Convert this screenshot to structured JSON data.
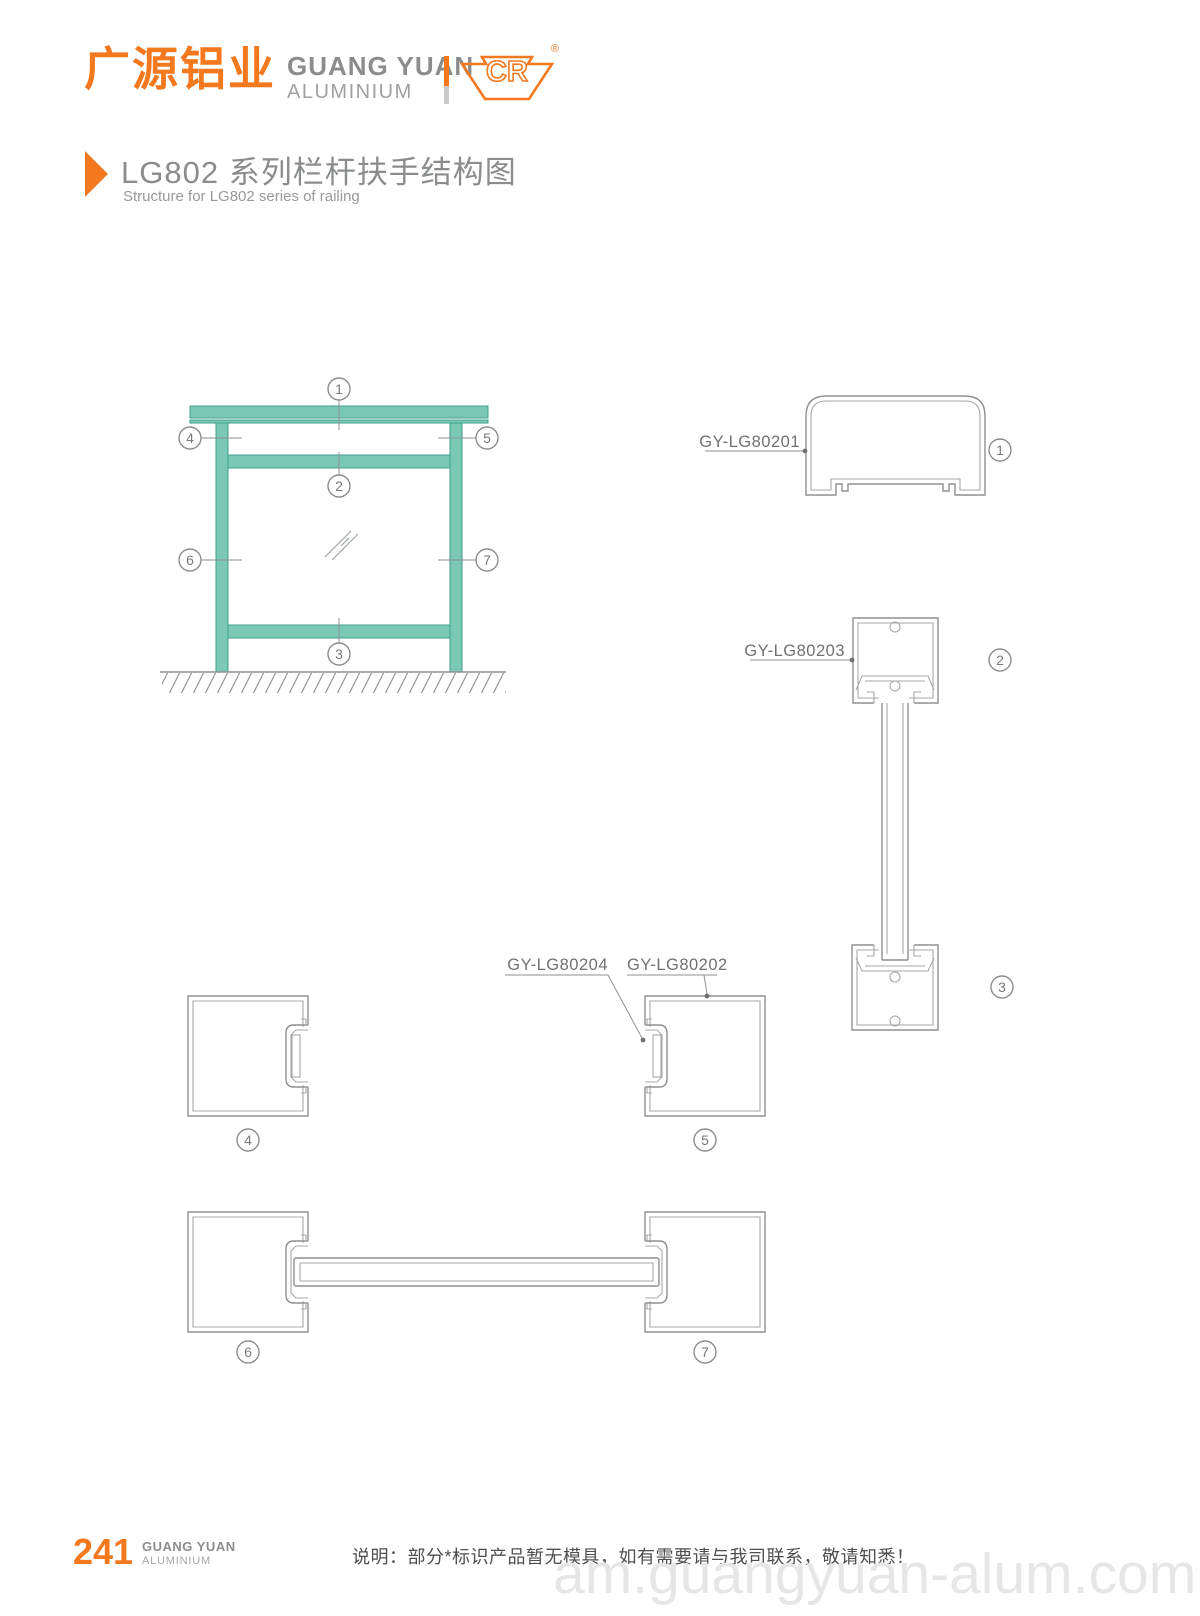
{
  "header": {
    "logo_cn": "广源铝业",
    "logo_en_line1": "GUANG YUAN",
    "logo_en_line2": "ALUMINIUM",
    "logo_mark_text": "CR",
    "registered_mark": "®"
  },
  "title": {
    "cn": "LG802 系列栏杆扶手结构图",
    "en": "Structure for LG802 series of railing"
  },
  "diagram": {
    "callouts": {
      "n1": "1",
      "n2": "2",
      "n3": "3",
      "n4": "4",
      "n5": "5",
      "n6": "6",
      "n7": "7"
    },
    "labels": {
      "p80201": "GY-LG80201",
      "p80203": "GY-LG80203",
      "p80204": "GY-LG80204",
      "p80202": "GY-LG80202"
    }
  },
  "footer": {
    "page_number": "241",
    "brand_line1": "GUANG YUAN",
    "brand_line2": "ALUMINIUM",
    "note": "说明：部分*标识产品暂无模具，如有需要请与我司联系，敬请知悉！",
    "watermark": "am.guangyuan-alum.com"
  },
  "colors": {
    "accent_orange": "#F4791E",
    "teal_fill": "#7BC8B5",
    "teal_stroke": "#3FA08C",
    "drawing_gray": "#8E9091",
    "label_gray": "#6F7173",
    "watermark_gray": "#E6E6E6"
  }
}
